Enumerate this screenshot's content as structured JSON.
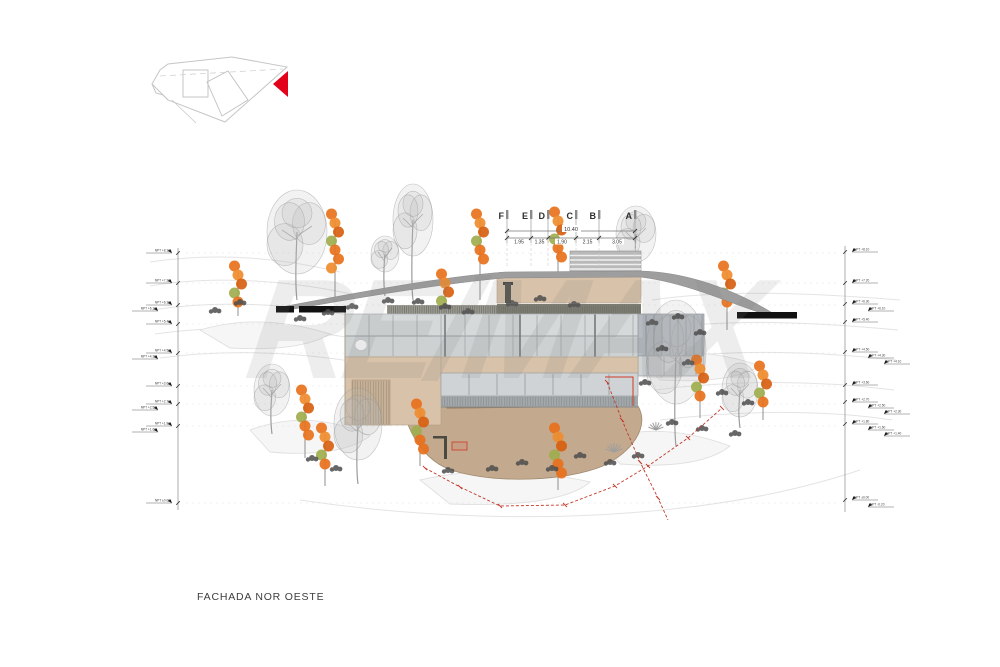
{
  "title": "FACHADA NOR OESTE",
  "watermark": "RE/MAX",
  "grid": {
    "letters": [
      "F",
      "E",
      "D",
      "C",
      "B",
      "A"
    ],
    "overall_dim": "10.40",
    "segment_dims": [
      "1.95",
      "1.35",
      "1.90",
      "2.15",
      "3.05"
    ]
  },
  "levels": {
    "left": [
      "NPT +8.10",
      "NPT +7.20",
      "NPT +6.30",
      "NPT +6.10",
      "NPT +5.40",
      "NPT +4.50",
      "NPT +4.30",
      "NPT +3.60",
      "NPT +2.70",
      "NPT +2.50",
      "NPT +1.80",
      "NPT +1.60",
      "NPT ±0.00"
    ],
    "right": [
      "NPT +8.10",
      "NPT +7.20",
      "NPT +6.30",
      "NPT +6.10",
      "NPT +5.40",
      "NPT +4.50",
      "NPT +4.30",
      "NPT +4.10",
      "NPT +3.60",
      "NPT +2.70",
      "NPT +2.50",
      "NPT +2.30",
      "NPT +1.80",
      "NPT +1.60",
      "NPT +1.40",
      "NPT ±0.00",
      "NPT -0.20"
    ]
  },
  "colors": {
    "accent_red": "#e2001a",
    "boundary_red": "#c0392b",
    "wall_tan": "#d8c2a9",
    "terrain_brown": "#c3a98e",
    "roof_gray": "#9e9e9e",
    "glass_gray": "#d6d9da",
    "foliage_orange": "#e8711c",
    "foliage_green": "#9fae4e",
    "tree_gray": "#b5b5b5",
    "shrub_dark": "#4d4d4d"
  }
}
